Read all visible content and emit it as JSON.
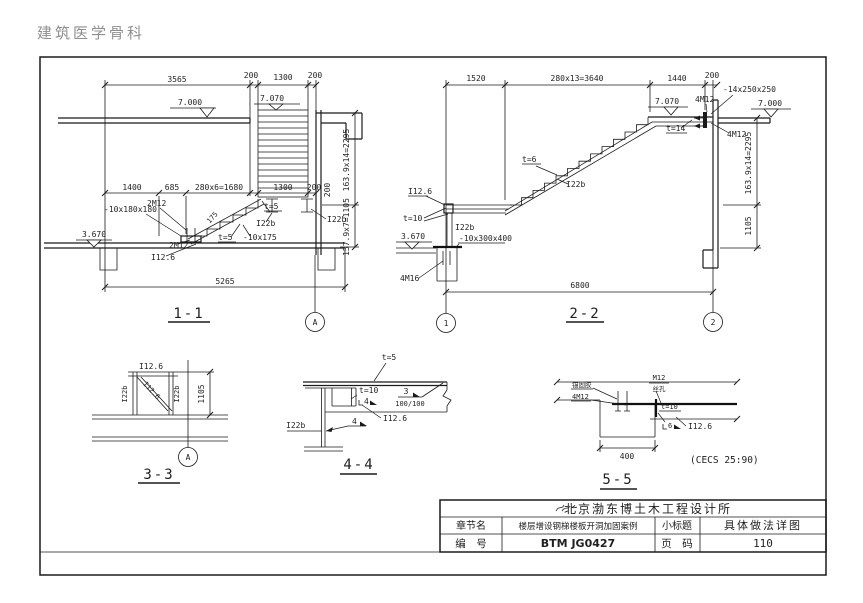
{
  "watermark": "建筑医学骨科",
  "s11": {
    "title": "1-1",
    "grid_a": "A",
    "dim_3565": "3565",
    "dim_200a": "200",
    "dim_1300a": "1300",
    "dim_200b": "200",
    "dim_1400": "1400",
    "dim_685": "685",
    "dim_1680": "280x6=1680",
    "dim_1300b": "1300",
    "dim_200c": "200",
    "dim_5265": "5265",
    "dim_v2295": "163.9x14=2295",
    "dim_v1105": "157.9x7=1105",
    "dim_v200": "200",
    "lvl_7000": "7.000",
    "lvl_7070": "7.070",
    "lvl_3670": "3.670",
    "lbl_plate180": "-10x180x180",
    "lbl_2m12a": "2M12",
    "lbl_2m12b": "2M12",
    "lbl_i126": "I12.6",
    "lbl_t5a": "t=5",
    "lbl_plate175": "-10x175",
    "lbl_175": "175",
    "lbl_t5b": "t=5",
    "lbl_i22ba": "I22b",
    "lbl_i22bb": "I22b"
  },
  "s22": {
    "title": "2-2",
    "grid_1": "1",
    "grid_2": "2",
    "dim_1520": "1520",
    "dim_3640": "280x13=3640",
    "dim_1440": "1440",
    "dim_200": "200",
    "dim_6800": "6800",
    "dim_v2295": "163.9x14=2295",
    "dim_v1105": "1105",
    "lvl_7070": "7.070",
    "lvl_7000": "7.000",
    "lvl_3670": "3.670",
    "lbl_t6": "t=6",
    "lbl_i22b_slope": "I22b",
    "lbl_i126": "I12.6",
    "lbl_t10": "t=10",
    "lbl_i22b_post": "I22b",
    "lbl_plate300": "-10x300x400",
    "lbl_4m16": "4M16",
    "lbl_plate250": "-14x250x250",
    "lbl_4m12a": "4M12",
    "lbl_4m12b": "4M12",
    "lbl_t14": "t=14"
  },
  "s33": {
    "title": "3-3",
    "grid_a": "A",
    "dim_1105": "1105",
    "lbl_i126_top": "I12.6",
    "lbl_i126_diag": "I12.6",
    "lbl_i22b_l": "I22b",
    "lbl_i22b_r": "I22b"
  },
  "s44": {
    "title": "4-4",
    "lbl_t5": "t=5",
    "lbl_t10": "t=10",
    "lbl_w4a": "4",
    "lbl_w3": "3",
    "lbl_w100": "100/100",
    "lbl_i126": "I12.6",
    "lbl_w4b": "4",
    "lbl_i22b": "I22b"
  },
  "s55": {
    "title": "5-5",
    "dim_400": "400",
    "note": "(CECS 25:90)",
    "lbl_glue": "锚固胶",
    "lbl_4m12": "4M12",
    "lbl_m12": "M12",
    "lbl_hole": "丝孔",
    "lbl_t10": "t=10",
    "lbl_w6": "6",
    "lbl_i126": "I12.6"
  },
  "tb": {
    "company": "北京渤东博土木工程设计所",
    "r1c1": "章节名",
    "r1c2": "楼层增设钢梯楼板开洞加固案例",
    "r1c3": "小标题",
    "r1c4": "具体做法详图",
    "r2c1": "编　号",
    "r2c2": "BTM JG0427",
    "r2c3": "页　码",
    "r2c4": "110"
  }
}
